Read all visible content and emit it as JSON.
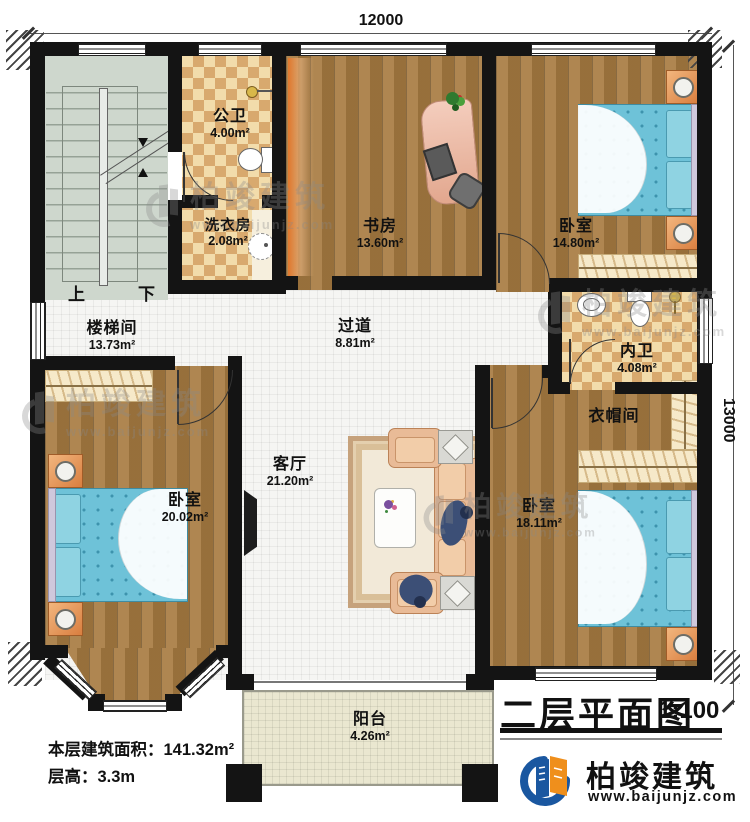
{
  "document": {
    "type": "floor-plan"
  },
  "title_block": {
    "title": "二层平面图",
    "scale": "1:100"
  },
  "brand": {
    "name": "柏竣建筑",
    "website": "www.baijunjz.com"
  },
  "dimensions": {
    "top": "12000",
    "right": "13000"
  },
  "info": {
    "area_label": "本层建筑面积：",
    "area_value": "141.32m²",
    "height_label": "层高：",
    "height_value": "3.3m"
  },
  "stairs": {
    "up_label": "上",
    "down_label": "下"
  },
  "rooms": [
    {
      "id": "stair-hall",
      "name": "楼梯间",
      "area": "13.73m²"
    },
    {
      "id": "public-bath",
      "name": "公卫",
      "area": "4.00m²"
    },
    {
      "id": "laundry",
      "name": "洗衣房",
      "area": "2.08m²"
    },
    {
      "id": "study",
      "name": "书房",
      "area": "13.60m²"
    },
    {
      "id": "bedroom-ne",
      "name": "卧室",
      "area": "14.80m²"
    },
    {
      "id": "hallway",
      "name": "过道",
      "area": "8.81m²"
    },
    {
      "id": "ensuite-bath",
      "name": "内卫",
      "area": "4.08m²"
    },
    {
      "id": "cloakroom",
      "name": "衣帽间",
      "area": ""
    },
    {
      "id": "bedroom-w",
      "name": "卧室",
      "area": "20.02m²"
    },
    {
      "id": "living-room",
      "name": "客厅",
      "area": "21.20m²"
    },
    {
      "id": "bedroom-se",
      "name": "卧室",
      "area": "18.11m²"
    },
    {
      "id": "balcony",
      "name": "阳台",
      "area": "4.26m²"
    }
  ],
  "watermark": {
    "brand": "柏竣建筑",
    "site": "www.baijunjz.com"
  },
  "colors": {
    "wall": "#141414",
    "wood_floor": "#a87c42",
    "checker_light": "#f2dcab",
    "checker_dark": "#d8a96e",
    "hall_tile": "#f5f5f3",
    "stair_floor": "#ced7cd",
    "balcony_floor": "#eae7d0",
    "bed_blue": "#6ec2d8",
    "sofa_peach": "#e9bb97",
    "brand_blue": "#1a57a0",
    "brand_orange": "#ef8f1c"
  }
}
